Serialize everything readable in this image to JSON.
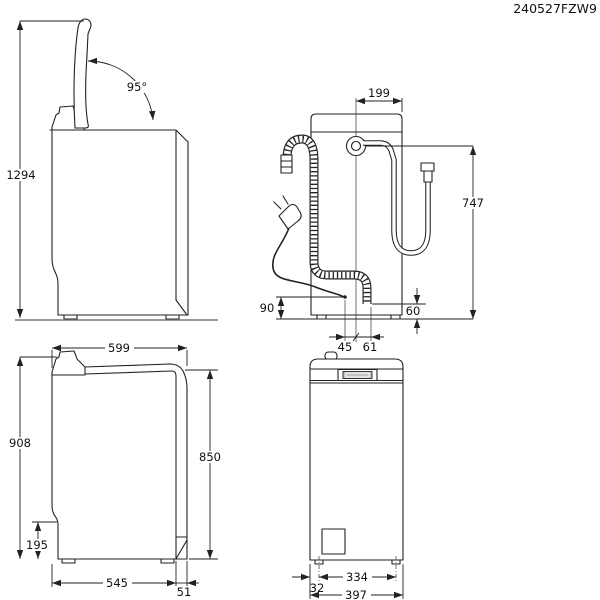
{
  "drawing": {
    "part_number": "240527FZW9",
    "side_open_view": {
      "overall_height": "1294",
      "lid_angle": "95°"
    },
    "rear_view": {
      "inlet_offset": "199",
      "inlet_hose_drop": "747",
      "cord_exit_height": "90",
      "drain_exit_height": "60",
      "cord_offset": "45",
      "drain_offset": "61"
    },
    "side_view": {
      "top_depth": "599",
      "total_height": "908",
      "body_height": "850",
      "plinth_height": "195",
      "base_depth": "545",
      "rear_gap": "51"
    },
    "front_view": {
      "feet_distance": "334",
      "foot_inset": "32",
      "width": "397"
    }
  }
}
